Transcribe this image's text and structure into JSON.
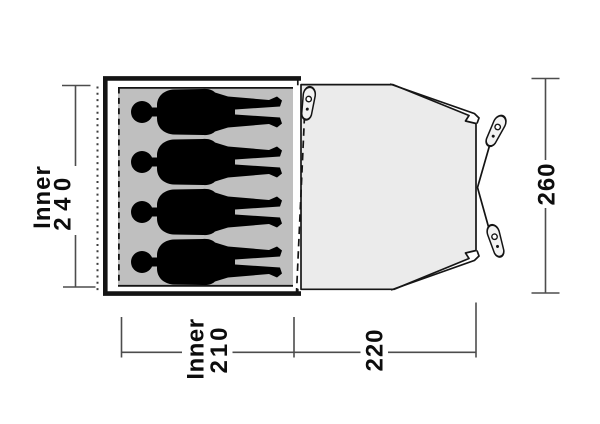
{
  "diagram": {
    "type": "tent-floorplan-top-view",
    "labels": {
      "inner_depth": {
        "word": "Inner",
        "value": "240"
      },
      "outer_depth": {
        "value": "260"
      },
      "inner_width": {
        "word": "Inner",
        "value": "210"
      },
      "porch_width": {
        "value": "220"
      }
    },
    "counts": {
      "sleeping_positions": 4,
      "pegs": 3
    },
    "colors": {
      "background": "#ffffff",
      "inner_area": "#bfbfbf",
      "porch_area": "#ebebeb",
      "outline": "#141414",
      "silhouette": "#000000",
      "dimension_lines": "#4d4d4d",
      "label_text": "#0d0d0d"
    }
  }
}
